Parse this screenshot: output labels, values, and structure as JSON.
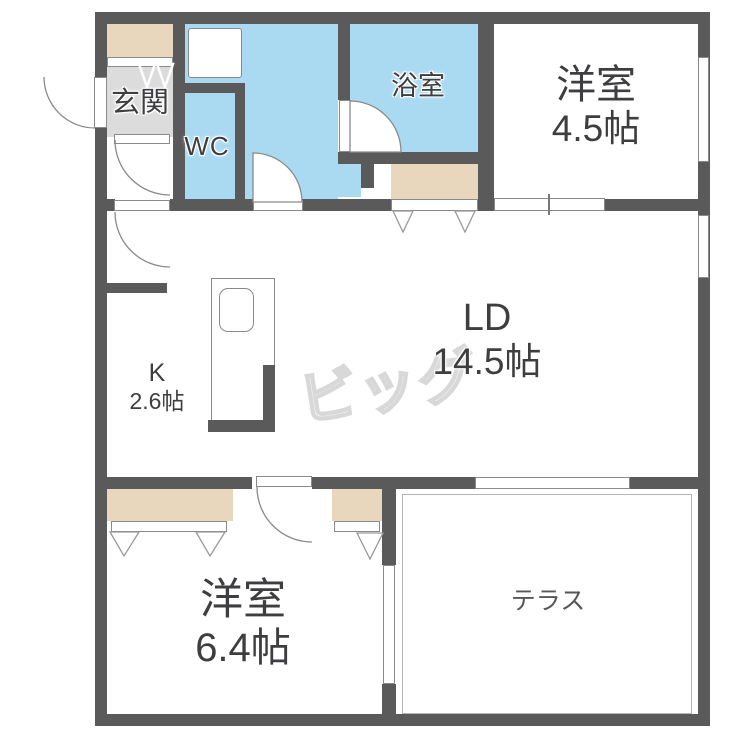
{
  "floorplan": {
    "watermark": "ビッグ",
    "rooms": {
      "genkan": {
        "label": "玄関"
      },
      "wc": {
        "label": "WC"
      },
      "bathroom": {
        "label": "浴室"
      },
      "bedroom1": {
        "label": "洋室",
        "size": "4.5帖"
      },
      "living": {
        "label": "LD",
        "size": "14.5帖"
      },
      "kitchen": {
        "label": "K",
        "size": "2.6帖"
      },
      "bedroom2": {
        "label": "洋室",
        "size": "6.4帖"
      },
      "terrace": {
        "label": "テラス"
      }
    },
    "colors": {
      "wall": "#5a5a5a",
      "water": "#a9daf2",
      "closet": "#e9d7bd",
      "genkan": "#dcdcdc",
      "line": "#8a8a8a",
      "label": "#3e3e40",
      "watermark": "#d8d8d8"
    }
  }
}
